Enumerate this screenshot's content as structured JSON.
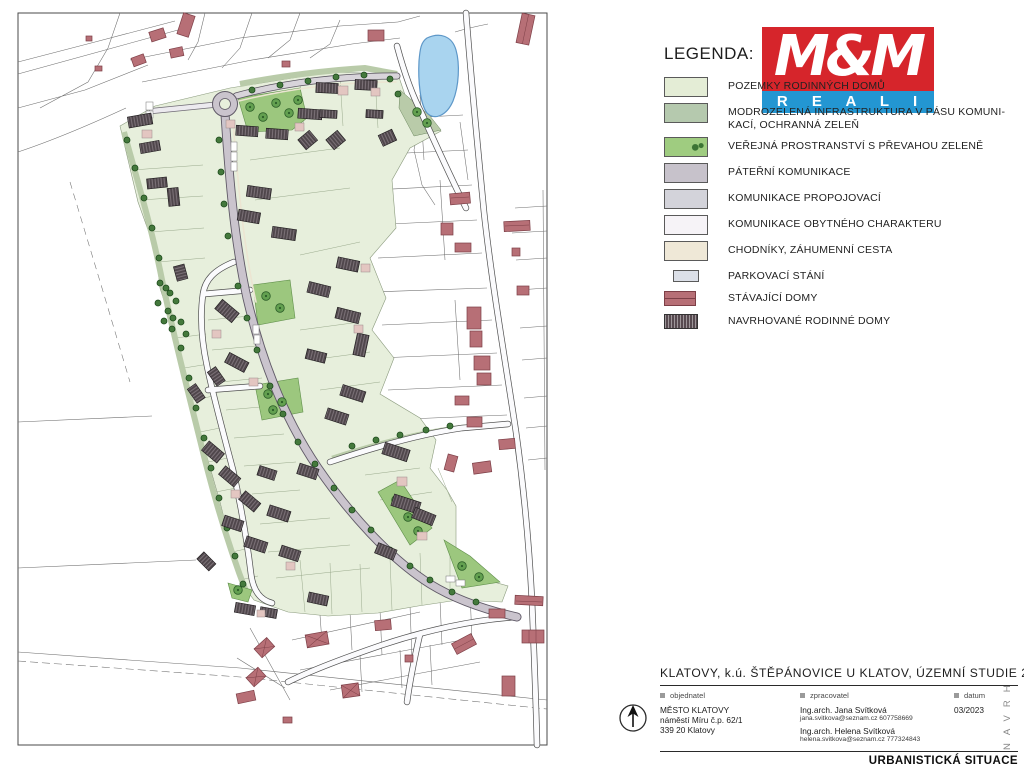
{
  "legend": {
    "title": "LEGENDA:",
    "items": [
      {
        "id": "pozemky",
        "label": "POZEMKY RODINNÝCH DOMŮ",
        "color": "#e4edd6"
      },
      {
        "id": "modrozelena",
        "label": "MODROZELENÁ INFRASTRUKTURA  V PÁSU KOMUNI-\nKACÍ, OCHRANNÁ ZELEŇ",
        "color": "#b5c9ae"
      },
      {
        "id": "verejna",
        "label": "VEŘEJNÁ  PROSTRANSTVÍ S PŘEVAHOU ZELENĚ",
        "color": "#9fcc80"
      },
      {
        "id": "paterni",
        "label": "PÁTEŘNÍ KOMUNIKACE",
        "color": "#c7c2cb"
      },
      {
        "id": "propojovaci",
        "label": "KOMUNIKACE PROPOJOVACÍ",
        "color": "#d3d3da"
      },
      {
        "id": "obytneho",
        "label": "KOMUNIKACE OBYTNÉHO CHARAKTERU",
        "color": "#f6f3f7"
      },
      {
        "id": "chodniky",
        "label": "CHODNÍKY, ZÁHUMENNÍ CESTA",
        "color": "#efe8d7"
      },
      {
        "id": "parkovaci",
        "label": "PARKOVACÍ STÁNÍ",
        "color": "#dce0e8"
      },
      {
        "id": "stavajici",
        "label": "STÁVAJÍCÍ DOMY",
        "color": "#b76f76"
      },
      {
        "id": "navrhovane",
        "label": "NAVRHOVANÉ RODINNÉ DOMY",
        "color": "#574a50"
      }
    ]
  },
  "logo": {
    "mm": "M&M",
    "reality": "R E A L I T Y",
    "red": "#d6252b",
    "blue": "#2396d2"
  },
  "title_block": {
    "title": "KLATOVY, k.ú. ŠTĚPÁNOVICE U KLATOV, ÚZEMNÍ STUDIE 23",
    "objednatel": {
      "label": "objednatel",
      "lines": [
        "MĚSTO KLATOVY",
        "náměstí Míru č.p. 62/1",
        "339 20 Klatovy"
      ]
    },
    "zpracovatel": {
      "label": "zpracovatel",
      "name1": "Ing.arch. Jana Svítková",
      "contact1": "jana.svitkova@seznam.cz  607758669",
      "name2": "Ing.arch. Helena Svítková",
      "contact2": "helena.svitkova@seznam.cz  777324843"
    },
    "datum": {
      "label": "datum",
      "value": "03/2023"
    },
    "footer": "URBANISTICKÁ SITUACE",
    "side_label": "NAVRH"
  },
  "map": {
    "colors": {
      "pond": "#a9d4ef",
      "parcel_green": "#e7efdc",
      "strip_green": "#b9cba9",
      "public_green": "#9cc77e",
      "spine_road": "#cac4cd",
      "residential_road": "#fbfbfd",
      "sidewalk": "#efe8d7",
      "existing_house": "#b76f76",
      "proposed_house": "#4f464b",
      "annex": "#e3c6c1"
    }
  }
}
